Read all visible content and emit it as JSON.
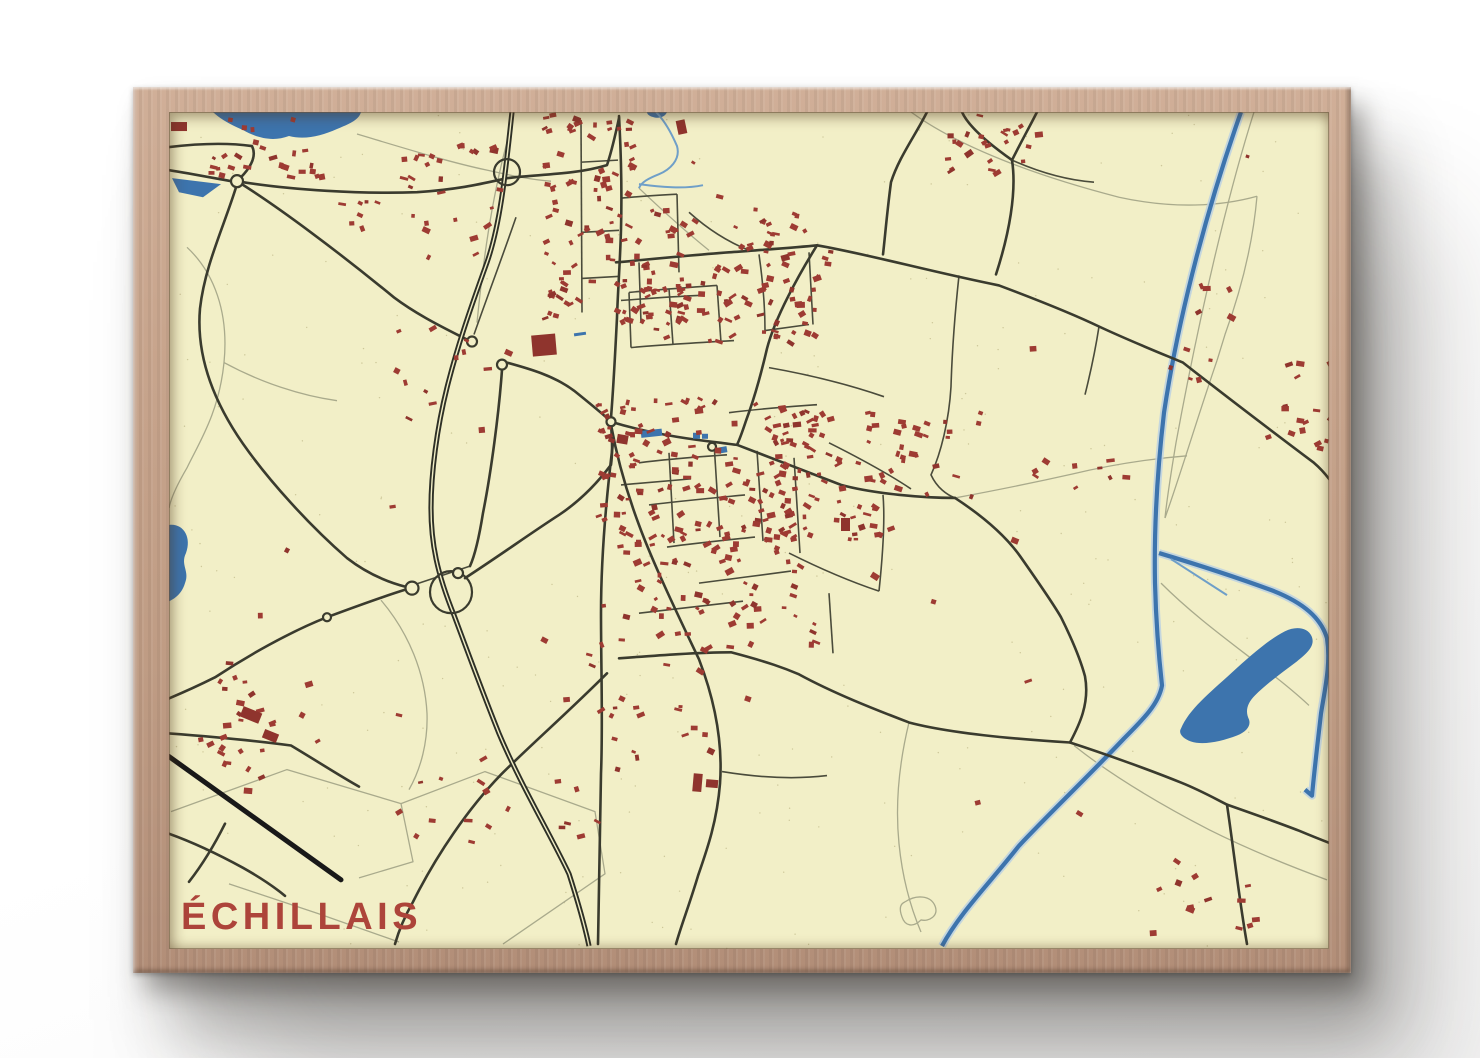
{
  "poster": {
    "title": "ÉCHILLAIS"
  },
  "colors": {
    "paper": "#f2efc7",
    "speckle": "#8a7f46",
    "road_dark": "#3a3b2e",
    "road_mid": "#4a4b3b",
    "road_light": "#a9aa8c",
    "highway": "#2e3026",
    "rail": "#191919",
    "water": "#3d74ad",
    "water_light": "#6f9fc8",
    "water_casing": "#bcd1e2",
    "building": "#9e3b33",
    "building_dark": "#8f342d",
    "title_red": "#ad443a",
    "frame_wood": "#c5a48c"
  },
  "map": {
    "width": 1160,
    "height": 835,
    "speckle": {
      "n": 300,
      "seed": 99
    },
    "water_polys": [
      "M44,0 L192,0 C190,8 180,12 168,17 C152,24 136,28 120,24 C104,30 88,26 74,18 C60,12 50,6 44,0 Z",
      "M3,66 L52,72 L34,85 L10,80 Z",
      "M0,412 C14,410 23,424 17,440 C11,452 21,458 16,470 C12,484 0,488 0,488 Z",
      "M1012,615 C1020,596 1040,580 1062,560 C1082,542 1100,526 1116,518 C1128,512 1140,515 1143,524 C1146,533 1138,540 1128,548 C1112,560 1098,570 1086,582 C1078,590 1076,598 1080,606 C1082,612 1078,618 1068,622 C1052,628 1034,632 1022,628 C1014,625 1009,620 1012,615 Z",
      "M478,0 L498,0 C496,5 490,7 484,5 C480,4 478,2 478,0 Z"
    ],
    "canals": [
      "M1072,0 C1040,90 1010,200 995,300 C988,360 985,420 986,470 C987,510 990,545 993,572 C990,590 975,605 955,625 C920,662 880,700 850,732 C820,770 790,800 773,832",
      "M990,440 C1030,452 1070,465 1105,478 C1135,490 1152,505 1158,525 C1162,550 1156,575 1152,600 C1148,635 1145,660 1143,682 L1136,676"
    ],
    "streams": [
      "M487,0 C495,8 502,20 508,34 C512,48 500,58 490,62 C480,66 472,70 470,76",
      "M470,72 C492,75 515,77 534,73",
      "M1002,446 L1058,482"
    ],
    "ponds": [
      [
        472,
        317,
        21,
        7,
        -6
      ],
      [
        524,
        320,
        7,
        6,
        0
      ],
      [
        533,
        321,
        6,
        5,
        0
      ],
      [
        550,
        334,
        8,
        6,
        -10
      ],
      [
        405,
        220,
        12,
        3,
        -8
      ]
    ],
    "roads_minor": [
      "M188,22 C235,36 280,50 318,58 C345,64 365,68 382,69",
      "M742,0 C790,35 868,64 950,85 C1005,97 1052,94 1088,84",
      "M1085,0 C1058,85 1030,205 1007,330 C1002,360 998,385 996,405",
      "M1088,84 C1084,130 1072,178 1056,222 L1048,248",
      "M1048,248 C1030,300 1012,360 996,405",
      "M18,135 C45,160 60,200 55,250 C50,300 30,330 18,355 C8,372 2,385 0,395",
      "M55,250 C92,270 132,283 168,288",
      "M2,698 L118,656 L232,690 L244,748 L190,764",
      "M232,690 L316,658 L426,698 L436,760 L334,830",
      "M60,770 L150,800 L230,828",
      "M212,487 C240,520 256,560 258,600 C259,628 252,655 240,676",
      "M992,470 C1020,498 1052,522 1082,545 C1105,562 1125,578 1140,592",
      "M905,632 C940,660 990,690 1040,716 C1080,736 1120,752 1158,766",
      "M470,76 C490,95 515,118 540,138",
      "M786,385 C824,378 864,370 904,361 C942,352 980,346 1018,343",
      "M740,609 C730,650 726,690 730,730 C733,760 740,790 752,818",
      "M736,788 C748,780 762,782 766,792 C770,802 760,808 752,806 C744,814 736,812 733,803 C730,795 731,790 736,788",
      "M338,30 C322,90 314,150 308,210"
    ],
    "roads_medium": [
      "M347,105 C335,140 318,185 305,222",
      "M790,163 C786,200 783,240 782,274 C780,308 772,340 762,362 C768,375 778,382 786,385",
      "M930,214 C926,240 921,262 916,282",
      "M412,8 L413,200",
      "M413,50 L449,48",
      "M413,120 L450,118",
      "M413,166 L449,164",
      "M452,86 C470,84 490,83 508,82",
      "M508,82 L510,160",
      "M452,188 C480,186 505,184 530,183",
      "M470,150 L472,210",
      "M460,180 C490,177 520,175 548,173",
      "M548,173 L552,230",
      "M500,176 L504,232",
      "M460,180 L462,235",
      "M462,235 C495,232 530,230 565,228",
      "M590,142 C594,170 596,195 596,218",
      "M596,218 L640,212",
      "M640,140 L644,212",
      "M520,100 C540,118 560,130 580,138",
      "M470,350 C500,346 530,344 558,342",
      "M480,392 C512,388 545,385 576,382",
      "M498,434 C528,430 558,427 586,424",
      "M452,372 L522,366",
      "M500,340 L505,430",
      "M545,330 L551,424",
      "M588,338 L594,428",
      "M625,345 L631,440",
      "M560,300 C590,296 620,294 648,292",
      "M600,255 C640,262 680,272 715,284",
      "M660,330 C690,345 718,360 742,376",
      "M620,440 C650,455 680,468 710,478",
      "M530,470 C560,466 592,462 622,458",
      "M470,500 C505,496 540,492 574,488",
      "M660,480 L664,540",
      "M710,478 C714,440 716,405 714,382",
      "M553,658 C590,664 625,666 658,662",
      "M238,474 L301,453",
      "M843,48 C870,60 898,68 925,70"
    ],
    "roads_major": [
      "M0,58 C25,62 45,66 62,69",
      "M68,69 C82,56 88,44 83,34 C55,30 25,32 0,35",
      "M68,69 C120,78 195,82 248,80 C292,77 315,71 338,66 C368,62 405,63 438,53 C443,38 447,20 450,6",
      "M68,69 C110,95 170,140 225,185 C245,200 268,212 290,223 L298,227",
      "M338,250 C360,256 385,263 405,278 C420,290 432,300 440,307",
      "M68,72 C56,112 36,152 31,196 C27,242 44,288 74,331 C100,368 140,412 178,445 C200,462 222,470 238,474",
      "M238,476 C215,483 185,494 158,504 C120,519 78,543 46,564 C28,573 12,580 0,585",
      "M450,4 C452,40 453,80 452,117 C451,152 449,175 448,205 C446,245 444,280 442,305",
      "M442,312 C448,345 458,380 470,412 C484,450 508,500 530,546 C545,585 554,628 551,670 C548,708 538,736 529,762 C520,792 512,812 507,830",
      "M444,330 C436,395 432,450 432,500 C432,555 434,610 432,660 C431,715 430,775 429,830",
      "M447,150 C480,147 520,143 560,140 C600,137 630,135 648,133 C700,142 760,159 830,173 C870,188 905,202 930,214 C960,228 990,240 1014,250 C1060,286 1105,320 1145,350 C1152,356 1157,362 1160,366",
      "M648,133 C630,162 606,205 598,236 C591,266 583,292 577,308 C573,320 570,328 568,332",
      "M442,309 C478,320 515,326 552,330 C560,331 565,332 568,332 C600,344 640,360 672,372 C705,381 755,385 786,385",
      "M786,385 C812,402 836,422 851,443 C870,470 884,490 892,504 C905,530 912,548 916,563 C921,590 910,612 901,629",
      "M450,545 C490,542 530,539 562,539 C600,549 616,555 630,561 C665,580 706,596 740,609 C782,620 852,626 901,629 C932,639 980,656 1012,669 C1032,677 1046,685 1058,691",
      "M1058,691 C1078,698 1112,710 1130,717 C1142,722 1152,726 1160,729",
      "M1058,691 C1065,738 1070,785 1078,830",
      "M793,0 C800,16 826,36 843,48 C848,80 840,122 827,162",
      "M868,0 C862,12 852,30 843,48",
      "M758,0 C746,24 730,45 722,70 C718,100 716,125 714,142",
      "M296,465 C330,443 362,420 390,402 C414,386 430,368 442,352 C444,338 443,324 442,312",
      "M333,257 C330,300 322,360 314,400 C310,425 306,442 301,453",
      "M438,560 C400,598 360,633 332,661 C300,694 268,740 244,788 C236,802 230,816 226,830",
      "M0,720 C28,730 52,742 74,754 C90,763 104,772 116,782",
      "M56,710 C46,730 34,750 20,768",
      "M0,620 C40,623 85,627 122,632 C152,650 172,663 190,673"
    ],
    "highway": "M343,0 C337,55 332,110 318,150 C300,200 288,235 278,275 C268,315 262,360 262,395 C262,430 268,460 285,502 C300,542 312,575 330,620 C352,672 380,718 400,760 C408,785 415,808 420,832",
    "railway": "M0,643 L172,766",
    "loops": [
      [
        282,
        479,
        21
      ],
      [
        338,
        60,
        13
      ]
    ],
    "roundabouts": [
      [
        68,
        69,
        6
      ],
      [
        243,
        475,
        6.5
      ],
      [
        289,
        460,
        5
      ],
      [
        158,
        504,
        4
      ],
      [
        442,
        309,
        4.5
      ],
      [
        543,
        334,
        4
      ],
      [
        303,
        229,
        5
      ],
      [
        333,
        252,
        5
      ]
    ],
    "clusters": [
      [
        35,
        5,
        115,
        60,
        26,
        1
      ],
      [
        225,
        30,
        105,
        115,
        26,
        2
      ],
      [
        168,
        75,
        50,
        40,
        7,
        3
      ],
      [
        372,
        0,
        90,
        210,
        85,
        4
      ],
      [
        465,
        95,
        60,
        110,
        30,
        5
      ],
      [
        460,
        150,
        190,
        80,
        70,
        6
      ],
      [
        560,
        95,
        100,
        55,
        24,
        7
      ],
      [
        775,
        0,
        95,
        70,
        24,
        8
      ],
      [
        1010,
        168,
        50,
        35,
        6,
        9
      ],
      [
        1090,
        245,
        70,
        115,
        16,
        10
      ],
      [
        425,
        285,
        200,
        140,
        130,
        11
      ],
      [
        600,
        295,
        135,
        130,
        75,
        12
      ],
      [
        445,
        420,
        200,
        115,
        70,
        13
      ],
      [
        725,
        295,
        85,
        90,
        18,
        14
      ],
      [
        45,
        548,
        105,
        105,
        22,
        15
      ],
      [
        225,
        205,
        130,
        110,
        13,
        16
      ],
      [
        235,
        655,
        190,
        80,
        16,
        17
      ],
      [
        385,
        525,
        160,
        120,
        22,
        18
      ],
      [
        975,
        735,
        115,
        85,
        13,
        19
      ],
      [
        855,
        335,
        110,
        50,
        9,
        20
      ],
      [
        60,
        40,
        1040,
        740,
        26,
        21
      ],
      [
        985,
        235,
        55,
        30,
        5,
        22
      ],
      [
        20,
        620,
        120,
        60,
        6,
        23
      ]
    ],
    "landmarks": [
      [
        363,
        222,
        24,
        21,
        -5
      ],
      [
        448,
        322,
        11,
        9,
        10
      ],
      [
        524,
        660,
        9,
        18,
        5
      ],
      [
        537,
        666,
        12,
        8,
        5
      ],
      [
        72,
        596,
        20,
        11,
        22
      ],
      [
        94,
        618,
        15,
        9,
        22
      ],
      [
        2,
        10,
        16,
        9,
        0
      ],
      [
        508,
        8,
        9,
        14,
        -12
      ],
      [
        672,
        405,
        9,
        13,
        0
      ]
    ]
  }
}
